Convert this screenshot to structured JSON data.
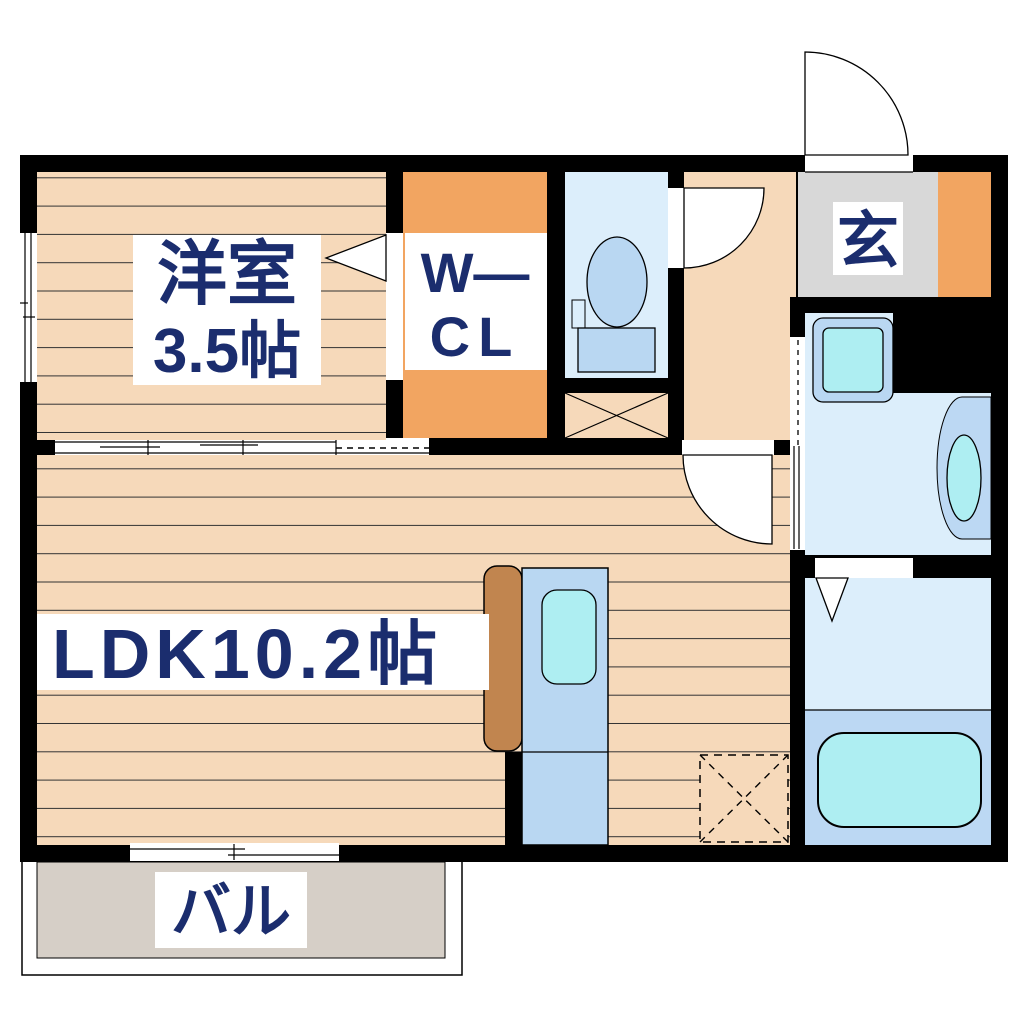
{
  "plan": {
    "rooms": {
      "western": {
        "line1": "洋室",
        "line2": "3.5帖"
      },
      "wcl": {
        "line1": "W—",
        "line2": "CL"
      },
      "entrance": {
        "label": "玄"
      },
      "ldk": {
        "label": "LDK10.2帖"
      },
      "balcony": {
        "label": "バル"
      }
    },
    "fixtures": [
      "toilet",
      "washing-machine",
      "wash-basin",
      "bathtub",
      "kitchen-sink",
      "kitchen-counter",
      "refrigerator-space",
      "pipe-shaft"
    ],
    "colors": {
      "wall": "#000000",
      "wood_floor": "#f6d9ba",
      "closet_orange": "#f2a561",
      "entrance_gray": "#d8d8d8",
      "wet_room_blue": "#dceefb",
      "fixture_blue": "#b9d7f2",
      "water_cyan": "#aeeef2",
      "bath_lower_blue": "#bcd8f3",
      "balcony_gray": "#d6cfc7",
      "counter_brown": "#c1854f",
      "label_text": "#1b2d6e"
    }
  }
}
